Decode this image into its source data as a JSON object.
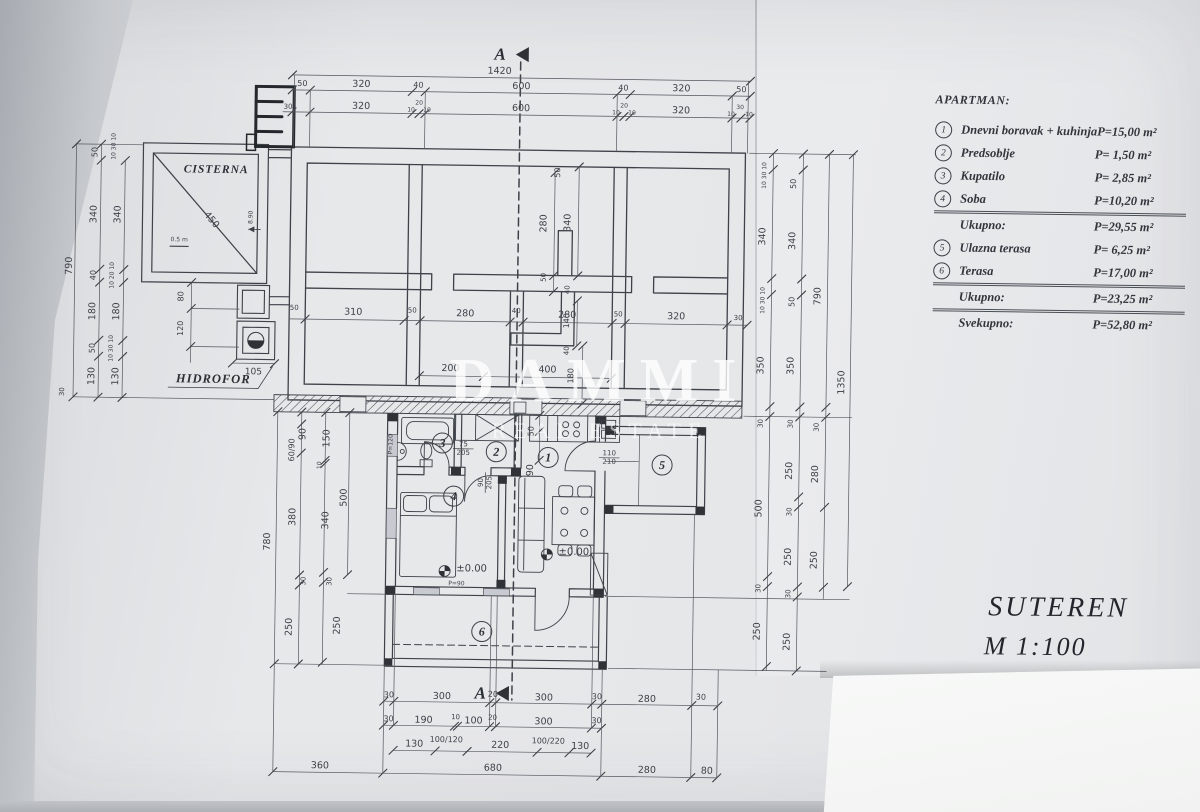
{
  "legend": {
    "title": "APARTMAN:",
    "rows": [
      {
        "num": "1",
        "label": "Dnevni boravak + kuhinja",
        "value": "P=15,00 m²"
      },
      {
        "num": "2",
        "label": "Predsoblje",
        "value": "P= 1,50 m²"
      },
      {
        "num": "3",
        "label": "Kupatilo",
        "value": "P= 2,85 m²"
      },
      {
        "num": "4",
        "label": "Soba",
        "value": "P=10,20 m²"
      },
      {
        "label": "Ukupno:",
        "value": "P=29,55 m²",
        "sep": true
      },
      {
        "num": "5",
        "label": "Ulazna terasa",
        "value": "P= 6,25 m²"
      },
      {
        "num": "6",
        "label": "Terasa",
        "value": "P=17,00 m²"
      },
      {
        "label": "Ukupno:",
        "value": "P=23,25 m²",
        "sep": true
      },
      {
        "label": "Svekupno:",
        "value": "P=52,80 m²",
        "sep": true
      }
    ]
  },
  "titleblock": {
    "title": "SUTEREN",
    "scale": "M 1:100"
  },
  "watermark": {
    "line1": "DAMMI",
    "line2": "REAL ESTATE"
  },
  "plan": {
    "section": {
      "letter": "A"
    },
    "labels": {
      "cisterna": "CISTERNA",
      "hidrofor": "HIDROFOR"
    },
    "room_numbers": [
      {
        "n": "1",
        "x": 549,
        "y": 457
      },
      {
        "n": "2",
        "x": 497,
        "y": 452
      },
      {
        "n": "3",
        "x": 443,
        "y": 444
      },
      {
        "n": "4",
        "x": 455,
        "y": 497
      },
      {
        "n": "5",
        "x": 663,
        "y": 463
      },
      {
        "n": "6",
        "x": 485,
        "y": 632
      }
    ],
    "dims": [
      {
        "t": "1420",
        "x": 495,
        "y": 74
      },
      {
        "t": "50",
        "x": 298,
        "y": 89,
        "s": 8
      },
      {
        "t": "320",
        "x": 357,
        "y": 89
      },
      {
        "t": "40",
        "x": 414,
        "y": 89,
        "s": 8
      },
      {
        "t": "600",
        "x": 517,
        "y": 89
      },
      {
        "t": "40",
        "x": 619,
        "y": 89,
        "s": 8
      },
      {
        "t": "320",
        "x": 677,
        "y": 89
      },
      {
        "t": "50",
        "x": 737,
        "y": 89,
        "s": 8
      },
      {
        "t": "320",
        "x": 357,
        "y": 111
      },
      {
        "t": "600",
        "x": 517,
        "y": 111
      },
      {
        "t": "320",
        "x": 677,
        "y": 111
      },
      {
        "t": "30",
        "x": 284,
        "y": 112,
        "s": 7
      },
      {
        "t": "10",
        "x": 407,
        "y": 113,
        "s": 6
      },
      {
        "t": "20",
        "x": 415,
        "y": 106,
        "s": 6
      },
      {
        "t": "10",
        "x": 423,
        "y": 113,
        "s": 6
      },
      {
        "t": "10",
        "x": 612,
        "y": 113,
        "s": 6
      },
      {
        "t": "20",
        "x": 620,
        "y": 106,
        "s": 6
      },
      {
        "t": "10",
        "x": 628,
        "y": 113,
        "s": 6
      },
      {
        "t": "10",
        "x": 727,
        "y": 113,
        "s": 6
      },
      {
        "t": "30",
        "x": 736,
        "y": 106,
        "s": 6
      },
      {
        "t": "10",
        "x": 745,
        "y": 113,
        "s": 6
      },
      {
        "t": "790",
        "x": 70,
        "y": 272,
        "r": -90
      },
      {
        "t": "50",
        "x": 94,
        "y": 158,
        "r": -90,
        "s": 8
      },
      {
        "t": "340",
        "x": 94,
        "y": 220,
        "r": -90
      },
      {
        "t": "40",
        "x": 94,
        "y": 281,
        "r": -90,
        "s": 8
      },
      {
        "t": "180",
        "x": 94,
        "y": 317,
        "r": -90
      },
      {
        "t": "50",
        "x": 94,
        "y": 354,
        "r": -90,
        "s": 8
      },
      {
        "t": "130",
        "x": 94,
        "y": 382,
        "r": -90
      },
      {
        "t": "340",
        "x": 118,
        "y": 220,
        "r": -90
      },
      {
        "t": "180",
        "x": 118,
        "y": 317,
        "r": -90
      },
      {
        "t": "130",
        "x": 118,
        "y": 382,
        "r": -90
      },
      {
        "t": "10 20 10",
        "x": 112,
        "y": 281,
        "r": -90,
        "s": 6
      },
      {
        "t": "10 30 10",
        "x": 112,
        "y": 354,
        "r": -90,
        "s": 6
      },
      {
        "t": "10 30 10",
        "x": 112,
        "y": 152,
        "r": -90,
        "s": 6
      },
      {
        "t": "30",
        "x": 64,
        "y": 398,
        "r": -90,
        "s": 7
      },
      {
        "t": "450",
        "x": 207,
        "y": 226,
        "r": 49
      },
      {
        "t": "0.5 m",
        "x": 177,
        "y": 246,
        "s": 6
      },
      {
        "t": "8.90",
        "x": 250,
        "y": 221,
        "r": -90,
        "s": 6
      },
      {
        "t": "80",
        "x": 182,
        "y": 301,
        "r": -90,
        "s": 8
      },
      {
        "t": "120",
        "x": 182,
        "y": 333,
        "r": -90,
        "s": 8
      },
      {
        "t": "105",
        "x": 253,
        "y": 378,
        "s": 9
      },
      {
        "t": "50",
        "x": 557,
        "y": 172,
        "r": -90,
        "s": 8
      },
      {
        "t": "280",
        "x": 544,
        "y": 223,
        "r": -90
      },
      {
        "t": "340",
        "x": 568,
        "y": 222,
        "r": -90
      },
      {
        "t": "50",
        "x": 544,
        "y": 277,
        "r": -90,
        "s": 7
      },
      {
        "t": "40",
        "x": 568,
        "y": 289,
        "r": -90,
        "s": 7
      },
      {
        "t": "310",
        "x": 352,
        "y": 317
      },
      {
        "t": "50",
        "x": 411,
        "y": 314,
        "s": 7
      },
      {
        "t": "280",
        "x": 464,
        "y": 317
      },
      {
        "t": "40",
        "x": 515,
        "y": 313,
        "s": 7
      },
      {
        "t": "280",
        "x": 566,
        "y": 317
      },
      {
        "t": "50",
        "x": 617,
        "y": 315,
        "s": 7
      },
      {
        "t": "320",
        "x": 675,
        "y": 317
      },
      {
        "t": "30",
        "x": 737,
        "y": 317,
        "s": 7
      },
      {
        "t": "50",
        "x": 293,
        "y": 313,
        "s": 7
      },
      {
        "t": "140",
        "x": 568,
        "y": 320,
        "r": -90,
        "s": 8
      },
      {
        "t": "200",
        "x": 450,
        "y": 372
      },
      {
        "t": "400",
        "x": 547,
        "y": 372
      },
      {
        "t": "180",
        "x": 573,
        "y": 375,
        "r": -90,
        "s": 8
      },
      {
        "t": "40",
        "x": 568,
        "y": 350,
        "r": -90,
        "s": 7
      },
      {
        "t": "10 30 10",
        "x": 763,
        "y": 172,
        "r": -90,
        "s": 6
      },
      {
        "t": "340",
        "x": 763,
        "y": 233,
        "r": -90
      },
      {
        "t": "10 30 10",
        "x": 763,
        "y": 297,
        "r": -90,
        "s": 6
      },
      {
        "t": "350",
        "x": 763,
        "y": 362,
        "r": -90
      },
      {
        "t": "30",
        "x": 763,
        "y": 420,
        "r": -90,
        "s": 7
      },
      {
        "t": "500",
        "x": 763,
        "y": 505,
        "r": -90
      },
      {
        "t": "30",
        "x": 763,
        "y": 585,
        "r": -90,
        "s": 7
      },
      {
        "t": "250",
        "x": 763,
        "y": 628,
        "r": -90
      },
      {
        "t": "50",
        "x": 793,
        "y": 180,
        "r": -90,
        "s": 8
      },
      {
        "t": "340",
        "x": 793,
        "y": 237,
        "r": -90
      },
      {
        "t": "50",
        "x": 793,
        "y": 298,
        "r": -90,
        "s": 8
      },
      {
        "t": "350",
        "x": 793,
        "y": 362,
        "r": -90
      },
      {
        "t": "30",
        "x": 793,
        "y": 420,
        "r": -90,
        "s": 7
      },
      {
        "t": "250",
        "x": 793,
        "y": 467,
        "r": -90
      },
      {
        "t": "30",
        "x": 793,
        "y": 508,
        "r": -90,
        "s": 7
      },
      {
        "t": "250",
        "x": 793,
        "y": 553,
        "r": -90
      },
      {
        "t": "30",
        "x": 793,
        "y": 590,
        "r": -90,
        "s": 7
      },
      {
        "t": "250",
        "x": 793,
        "y": 638,
        "r": -90
      },
      {
        "t": "790",
        "x": 819,
        "y": 292,
        "r": -90
      },
      {
        "t": "30",
        "x": 819,
        "y": 423,
        "r": -90,
        "s": 7
      },
      {
        "t": "280",
        "x": 819,
        "y": 470,
        "r": -90
      },
      {
        "t": "250",
        "x": 819,
        "y": 556,
        "r": -90
      },
      {
        "t": "1350",
        "x": 844,
        "y": 378,
        "r": -90
      },
      {
        "t": "780",
        "x": 272,
        "y": 545,
        "r": -90
      },
      {
        "t": "60/90",
        "x": 295,
        "y": 453,
        "r": -90,
        "s": 8
      },
      {
        "t": "90",
        "x": 306,
        "y": 437,
        "r": -90
      },
      {
        "t": "380",
        "x": 297,
        "y": 520,
        "r": -90
      },
      {
        "t": "30",
        "x": 308,
        "y": 584,
        "r": -90,
        "s": 7
      },
      {
        "t": "250",
        "x": 295,
        "y": 630,
        "r": -90
      },
      {
        "t": "150",
        "x": 330,
        "y": 441,
        "r": -90
      },
      {
        "t": "10",
        "x": 322,
        "y": 468,
        "r": -90,
        "s": 6
      },
      {
        "t": "340",
        "x": 330,
        "y": 523,
        "r": -90
      },
      {
        "t": "30",
        "x": 334,
        "y": 584,
        "r": -90,
        "s": 7
      },
      {
        "t": "250",
        "x": 343,
        "y": 628,
        "r": -90
      },
      {
        "t": "500",
        "x": 348,
        "y": 500,
        "r": -90
      },
      {
        "t": "50",
        "x": 534,
        "y": 431,
        "r": -90,
        "s": 8
      },
      {
        "t": "90",
        "x": 534,
        "y": 470,
        "r": -90
      },
      {
        "t": "75/205",
        "x": 464,
        "y": 449,
        "s": 7,
        "f": 1
      },
      {
        "t": "90/205",
        "x": 486,
        "y": 483,
        "s": 7,
        "f": 1,
        "r": -90
      },
      {
        "t": "110/210",
        "x": 610,
        "y": 456,
        "s": 7,
        "f": 1
      },
      {
        "t": "P=120",
        "x": 393,
        "y": 446,
        "r": -90,
        "s": 6
      },
      {
        "t": "±0.00",
        "x": 474,
        "y": 572,
        "s": 10
      },
      {
        "t": "±0.00",
        "x": 576,
        "y": 554,
        "s": 10
      },
      {
        "t": "P=90",
        "x": 459,
        "y": 586,
        "s": 6
      },
      {
        "t": "30",
        "x": 393,
        "y": 699,
        "s": 8
      },
      {
        "t": "300",
        "x": 446,
        "y": 700
      },
      {
        "t": "20",
        "x": 497,
        "y": 697,
        "s": 8
      },
      {
        "t": "300",
        "x": 548,
        "y": 700
      },
      {
        "t": "30",
        "x": 601,
        "y": 698,
        "s": 8
      },
      {
        "t": "280",
        "x": 651,
        "y": 700
      },
      {
        "t": "30",
        "x": 705,
        "y": 697,
        "s": 8
      },
      {
        "t": "30",
        "x": 393,
        "y": 723,
        "s": 8
      },
      {
        "t": "190",
        "x": 428,
        "y": 724
      },
      {
        "t": "10",
        "x": 460,
        "y": 720,
        "s": 7
      },
      {
        "t": "100",
        "x": 478,
        "y": 724
      },
      {
        "t": "20",
        "x": 497,
        "y": 720,
        "s": 7
      },
      {
        "t": "300",
        "x": 548,
        "y": 724
      },
      {
        "t": "30",
        "x": 601,
        "y": 722,
        "s": 8
      },
      {
        "t": "130",
        "x": 419,
        "y": 748
      },
      {
        "t": "100/120",
        "x": 451,
        "y": 743,
        "s": 8
      },
      {
        "t": "220",
        "x": 505,
        "y": 748
      },
      {
        "t": "100/220",
        "x": 553,
        "y": 743,
        "s": 8
      },
      {
        "t": "130",
        "x": 585,
        "y": 748
      },
      {
        "t": "360",
        "x": 325,
        "y": 771
      },
      {
        "t": "680",
        "x": 498,
        "y": 771
      },
      {
        "t": "280",
        "x": 652,
        "y": 771
      },
      {
        "t": "80",
        "x": 712,
        "y": 771
      }
    ]
  }
}
